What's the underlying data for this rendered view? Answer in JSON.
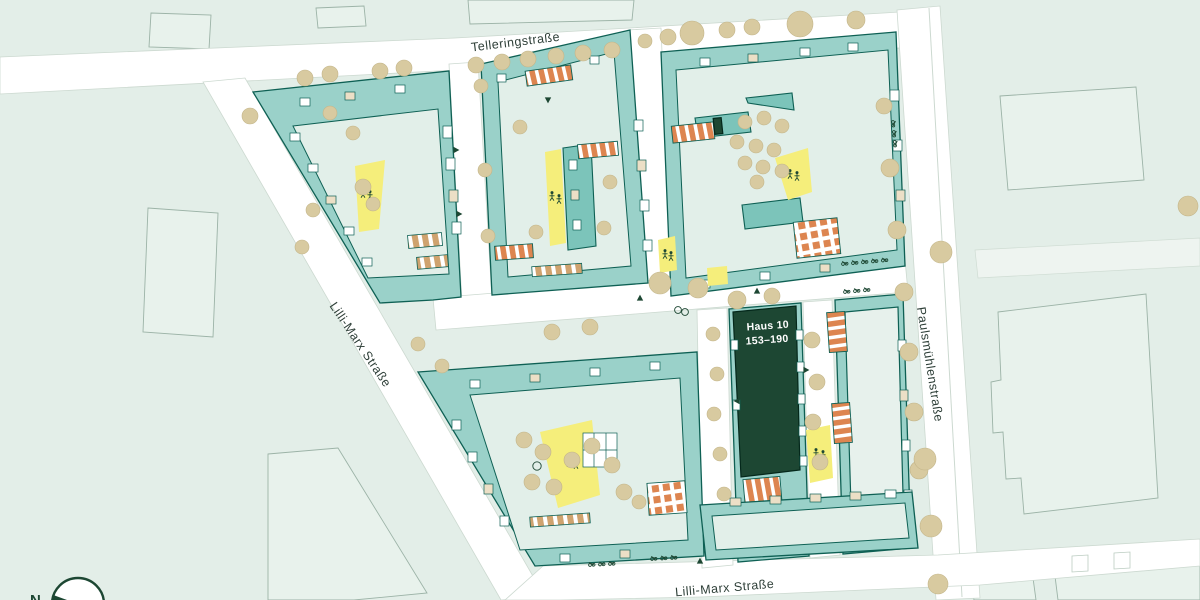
{
  "map": {
    "streets": {
      "top": "Telleringstraße",
      "left": "Lilli-Marx Straße",
      "right": "Paulsmühlenstraße",
      "bottom": "Lilli-Marx Straße"
    },
    "highlighted_building": {
      "name": "Haus 10",
      "numbers": "153–190"
    },
    "compass": {
      "label": "N"
    },
    "colors": {
      "background": "#e3eee8",
      "street": "#ffffff",
      "building": "#9ad1c9",
      "building_outline": "#0e6054",
      "courtyard": "#e2efe9",
      "highlight": "#1d4733",
      "playground": "#f5ee7b",
      "special": "#dd8550",
      "special_tan": "#cfa36f",
      "tree": "#d8caa0",
      "label": "#2e3f38"
    }
  }
}
